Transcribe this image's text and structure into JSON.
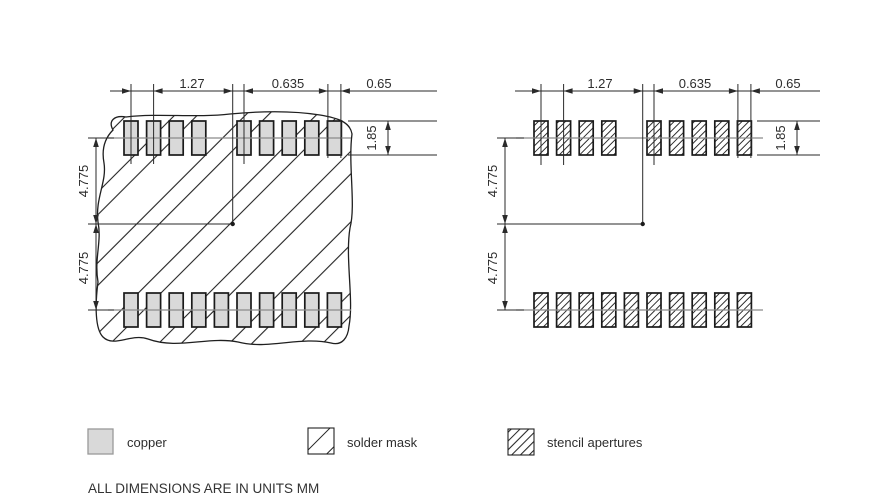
{
  "drawing": {
    "dims": {
      "pitch": "1.27",
      "half_pitch": "0.635",
      "pad_width": "0.65",
      "pad_height": "1.85",
      "row_spacing": "4.775"
    },
    "legend": [
      {
        "label": "copper"
      },
      {
        "label": "solder mask"
      },
      {
        "label": "stencil apertures"
      }
    ],
    "note": "ALL DIMENSIONS ARE IN UNITS MM",
    "colors": {
      "copper_fill": "#d9d9d9",
      "line": "#2a2a2a",
      "centerline": "#8a8a8a",
      "background": "#ffffff"
    }
  }
}
